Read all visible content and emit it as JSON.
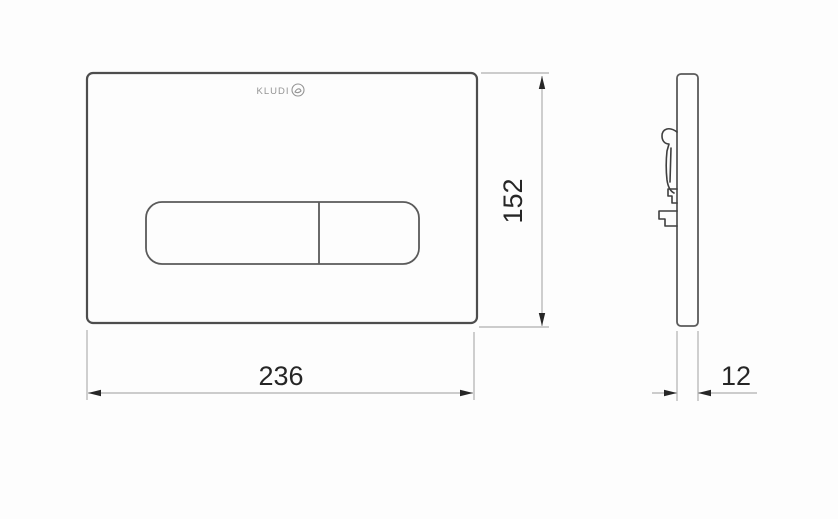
{
  "drawing": {
    "front_view": {
      "logo": "KLUDI",
      "width_dimension": "236",
      "height_dimension": "152"
    },
    "side_view": {
      "depth_dimension": "12"
    },
    "colors": {
      "plate_outline": "#4d4d4d",
      "inner_outline": "#5a5a5a",
      "dimension_line": "#b0b0b0",
      "dimension_text": "#262626",
      "logo_gray": "#949494",
      "background": "#fdfdfd"
    }
  }
}
